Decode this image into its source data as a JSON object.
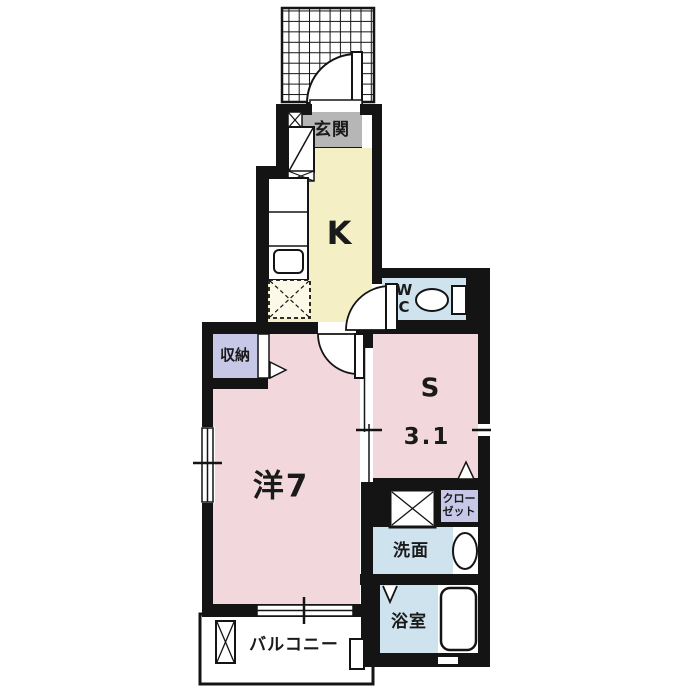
{
  "type": "floor-plan",
  "rooms": [
    {
      "id": "entrance",
      "label": "玄関"
    },
    {
      "id": "kitchen",
      "label": "K"
    },
    {
      "id": "toilet",
      "label": "W\nC"
    },
    {
      "id": "storage",
      "label": "収納"
    },
    {
      "id": "service-room",
      "label": "S",
      "size_label": "3.1"
    },
    {
      "id": "western-room",
      "label": "洋7"
    },
    {
      "id": "closet",
      "label": "クロー\nゼット"
    },
    {
      "id": "washroom",
      "label": "洗面"
    },
    {
      "id": "bathroom",
      "label": "浴室"
    },
    {
      "id": "balcony",
      "label": "バルコニー"
    }
  ],
  "palette": {
    "wall": "#141414",
    "room_pink": "#f2d8dc",
    "kitchen_cream": "#f5efc5",
    "water_blue": "#cfe3ef",
    "storage_lavender": "#c7c8e8",
    "entrance_gray": "#b6b6b6",
    "background": "#ffffff"
  }
}
